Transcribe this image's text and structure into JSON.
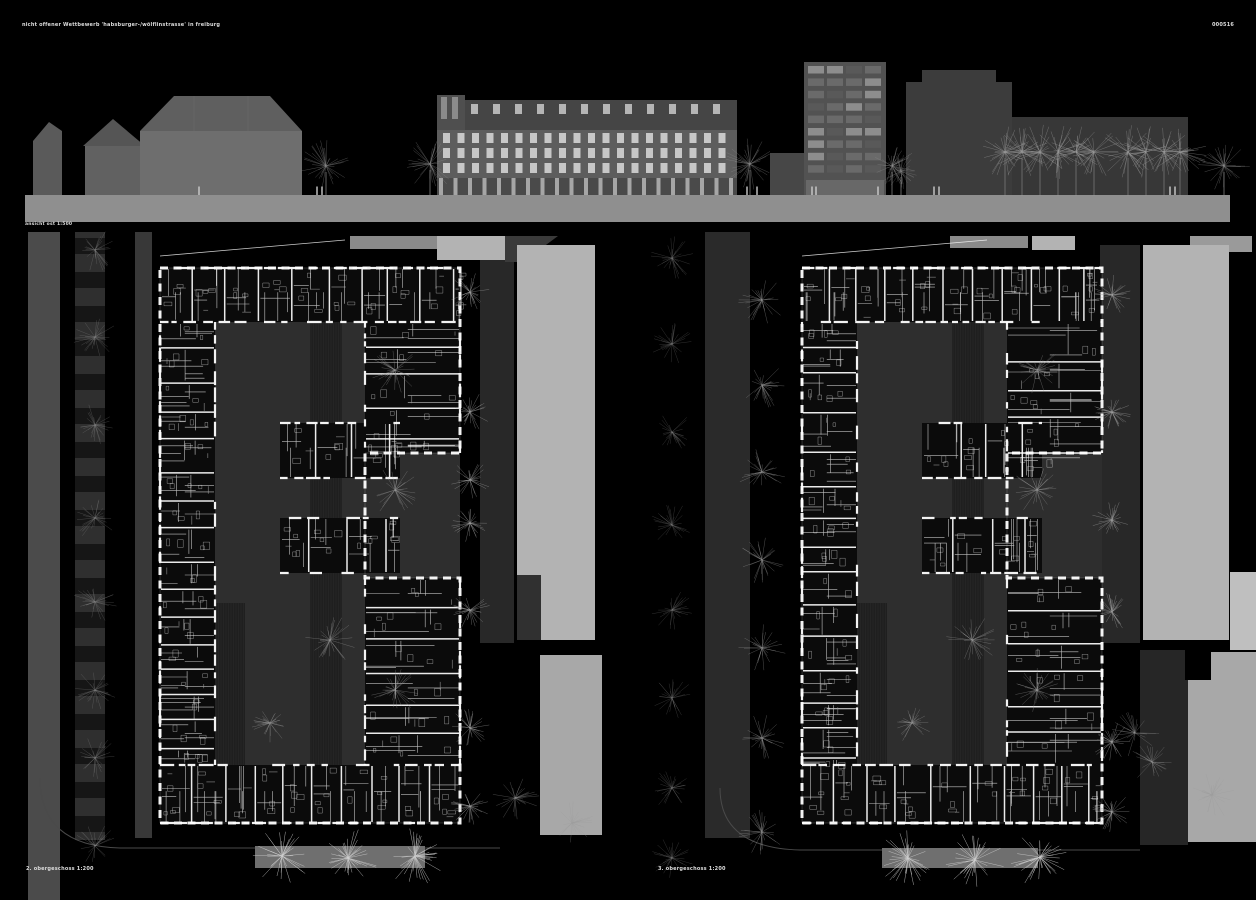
{
  "header": {
    "title": "nicht offener Wettbewerb 'habsburger-/wölflinstrasse' in freiburg",
    "code": "000516"
  },
  "elevation": {
    "caption": "ansicht ost 1:500"
  },
  "plans": {
    "left": {
      "caption": "2. obergeschoss 1:200"
    },
    "right": {
      "caption": "3. obergeschoss 1:200"
    }
  },
  "colors": {
    "background": "#000000",
    "ground": "#8f8f8f",
    "building_light": "#6e6e6e",
    "building_mid": "#585858",
    "building_dark": "#3c3c3c",
    "roof_dark": "#454545",
    "facade_window": "#d6d6d6",
    "plan_courtyard": "#2e2e2e",
    "plan_block": "#0b0b0b",
    "plan_street": "#2a2a2a",
    "plan_sidewalk": "#4b4b4b",
    "plan_band": "#6f6f6f",
    "neighbor_light": "#b3b3b3",
    "neighbor_light2": "#a8a8a8",
    "neighbor_mid": "#8a8a8a",
    "line_white": "#ffffff",
    "tree_faint": "#9b9b9b",
    "tree_bright": "#cfcfcf",
    "text": "#dcdcdc"
  }
}
